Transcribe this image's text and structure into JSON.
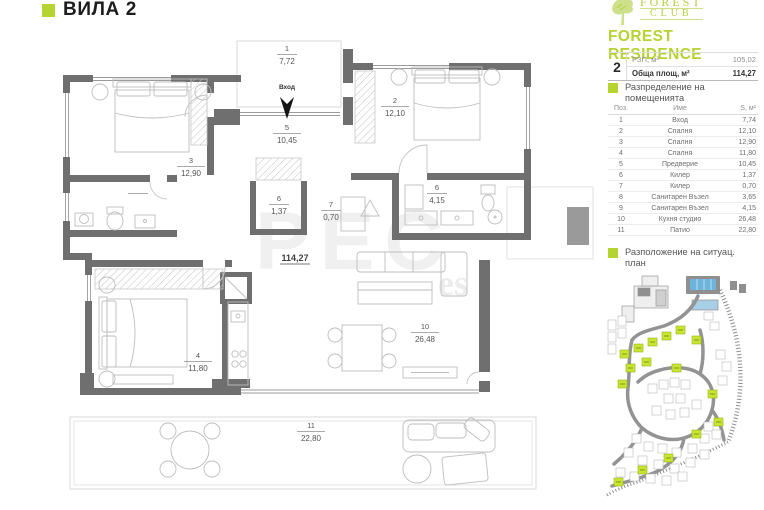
{
  "title": "ВИЛА 2",
  "brand": {
    "logo_line1": "FOREST",
    "logo_line2": "CLUB",
    "name": "FOREST RESIDENCE"
  },
  "spec": {
    "number": "2",
    "row1_label": "РЗП, м²",
    "row1_value": "105,02",
    "row2_label": "Обща площ, м²",
    "row2_value": "114,27"
  },
  "sections": {
    "rooms": "Разпределение на помещенията",
    "siteplan": "Разположение на ситуац. план"
  },
  "rooms_table": {
    "headers": {
      "pos": "Поз.",
      "name": "Име",
      "area": "S, м²"
    },
    "rows": [
      {
        "pos": "1",
        "name": "Вход",
        "area": "7,74"
      },
      {
        "pos": "2",
        "name": "Спалня",
        "area": "12,10"
      },
      {
        "pos": "3",
        "name": "Спалня",
        "area": "12,90"
      },
      {
        "pos": "4",
        "name": "Спалня",
        "area": "11,80"
      },
      {
        "pos": "5",
        "name": "Предверие",
        "area": "10,45"
      },
      {
        "pos": "6",
        "name": "Килер",
        "area": "1,37"
      },
      {
        "pos": "7",
        "name": "Килер",
        "area": "0,70"
      },
      {
        "pos": "8",
        "name": "Санитарен Възел",
        "area": "3,65"
      },
      {
        "pos": "9",
        "name": "Санитарен Възел",
        "area": "4,15"
      },
      {
        "pos": "10",
        "name": "Кухня студио",
        "area": "26,48"
      },
      {
        "pos": "11",
        "name": "Патио",
        "area": "22,80"
      }
    ]
  },
  "plan": {
    "total": "114,27",
    "entrance": "Вход",
    "rooms": {
      "r1": {
        "num": "1",
        "area": "7,72"
      },
      "r2": {
        "num": "2",
        "area": "12,10"
      },
      "r3": {
        "num": "3",
        "area": "12,90"
      },
      "r4": {
        "num": "4",
        "area": "11,80"
      },
      "r5": {
        "num": "5",
        "area": "10,45"
      },
      "r6": {
        "num": "6",
        "area": "1,37"
      },
      "r7": {
        "num": "7",
        "area": "0,70"
      },
      "r9": {
        "num": "6",
        "area": "4,15"
      },
      "r10": {
        "num": "10",
        "area": "26,48"
      },
      "r11": {
        "num": "11",
        "area": "22,80"
      }
    }
  },
  "watermark": {
    "big": "РЕС",
    "small": "es"
  },
  "colors": {
    "accent": "#b5d331",
    "wall": "#6f6f6f",
    "pool": "#6db4dc",
    "lot_green": "#c9e531"
  }
}
